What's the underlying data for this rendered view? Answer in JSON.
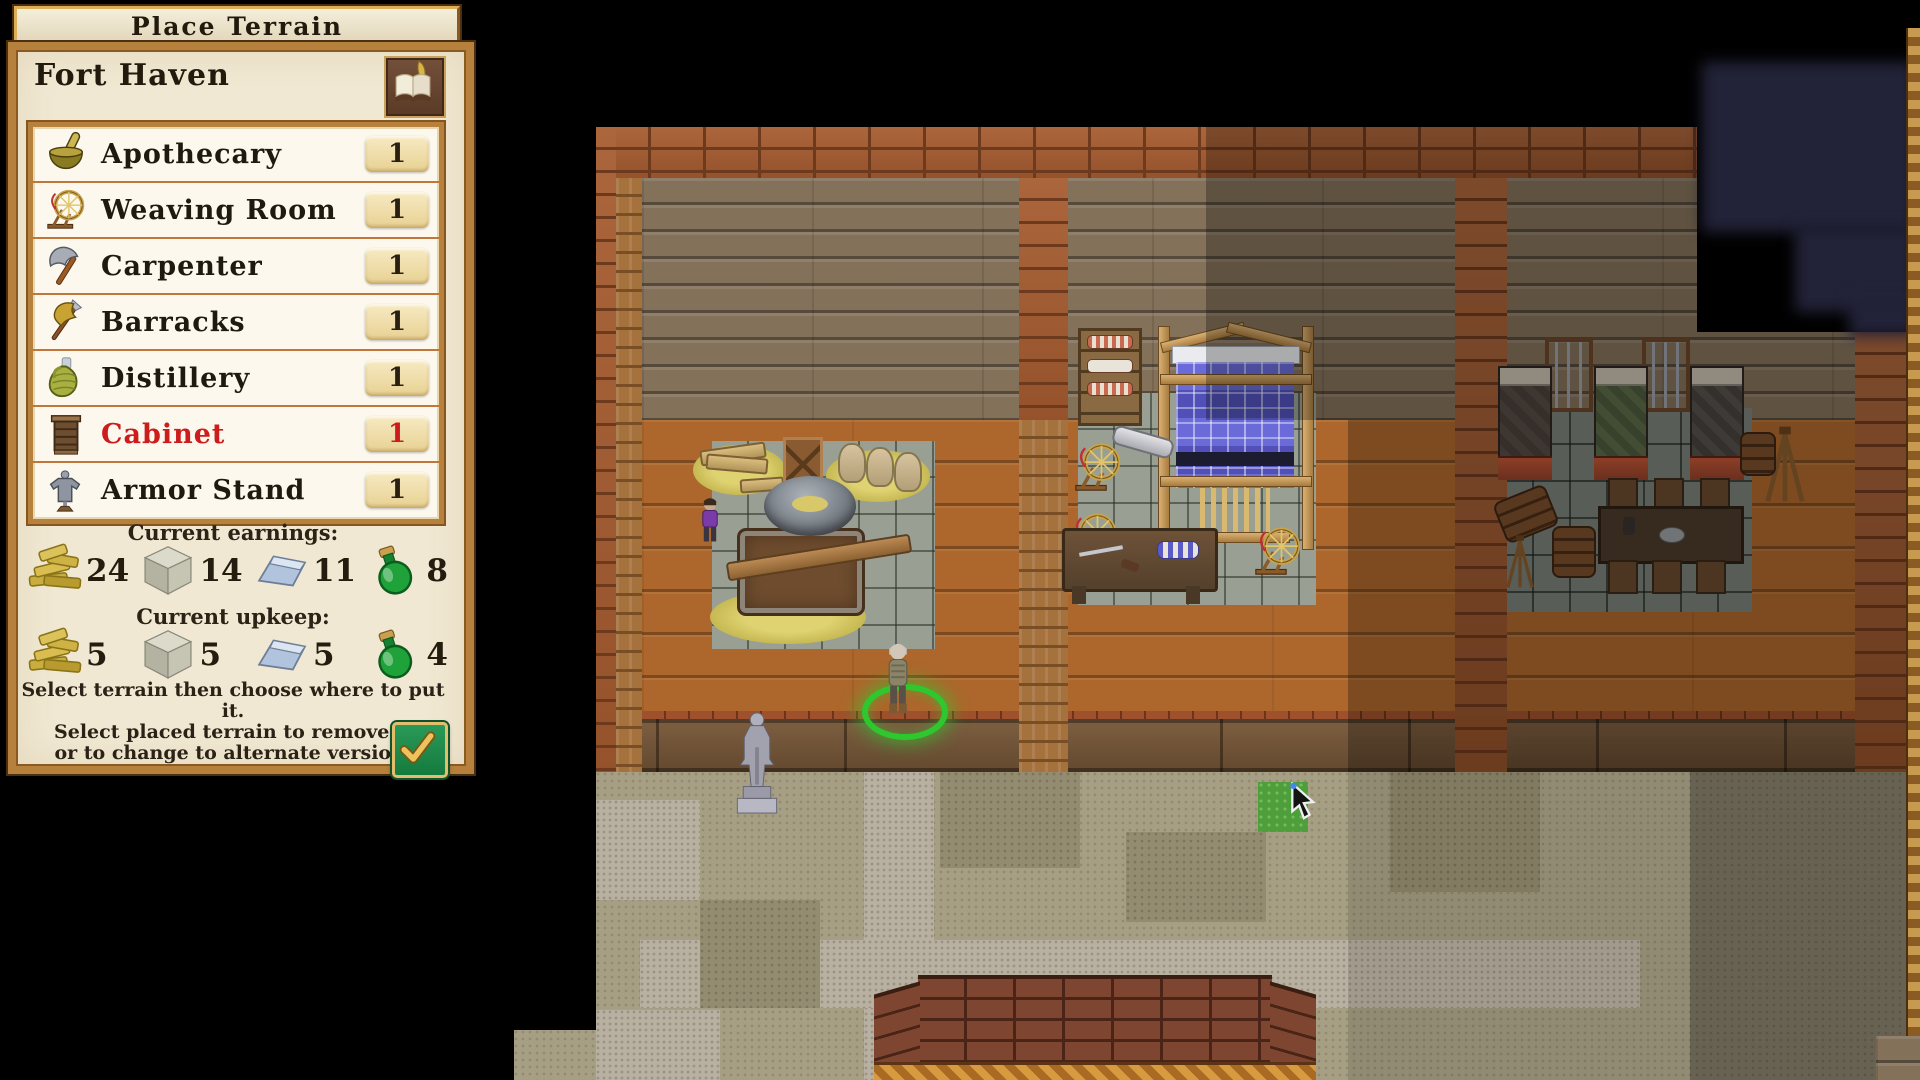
{
  "panel": {
    "title": "Place Terrain",
    "location_name": "Fort Haven",
    "items": [
      {
        "icon": "mortar-pestle-icon",
        "label": "Apothecary",
        "count": "1"
      },
      {
        "icon": "spinning-wheel-icon",
        "label": "Weaving Room",
        "count": "1"
      },
      {
        "icon": "axe-icon",
        "label": "Carpenter",
        "count": "1"
      },
      {
        "icon": "halberd-icon",
        "label": "Barracks",
        "count": "1"
      },
      {
        "icon": "wicker-jug-icon",
        "label": "Distillery",
        "count": "1"
      },
      {
        "icon": "cabinet-icon",
        "label": "Cabinet",
        "count": "1",
        "selected": true
      },
      {
        "icon": "armor-stand-icon",
        "label": "Armor Stand",
        "count": "1"
      }
    ],
    "earnings": {
      "label": "Current earnings:",
      "resources": [
        {
          "icon": "wood-icon",
          "value": "24"
        },
        {
          "icon": "stone-icon",
          "value": "14"
        },
        {
          "icon": "metal-ingot-icon",
          "value": "11"
        },
        {
          "icon": "potion-icon",
          "value": "8"
        }
      ]
    },
    "upkeep": {
      "label": "Current upkeep:",
      "resources": [
        {
          "icon": "wood-icon",
          "value": "5"
        },
        {
          "icon": "stone-icon",
          "value": "5"
        },
        {
          "icon": "metal-ingot-icon",
          "value": "5"
        },
        {
          "icon": "potion-icon",
          "value": "4"
        }
      ]
    },
    "instructions": [
      "Select terrain then choose where to put it.",
      "Select placed terrain to remove it",
      "or to change to alternate version."
    ]
  },
  "colors": {
    "panel_gold": "#b5813c",
    "parchment": "#f0e8d2",
    "selected_item_red": "#cc1c1c",
    "confirm_green": "#1f8a4a",
    "selection_ring_green": "#2ec82e",
    "placement_tile_green": "#4e9e3c",
    "fog_navy": "#222238"
  }
}
